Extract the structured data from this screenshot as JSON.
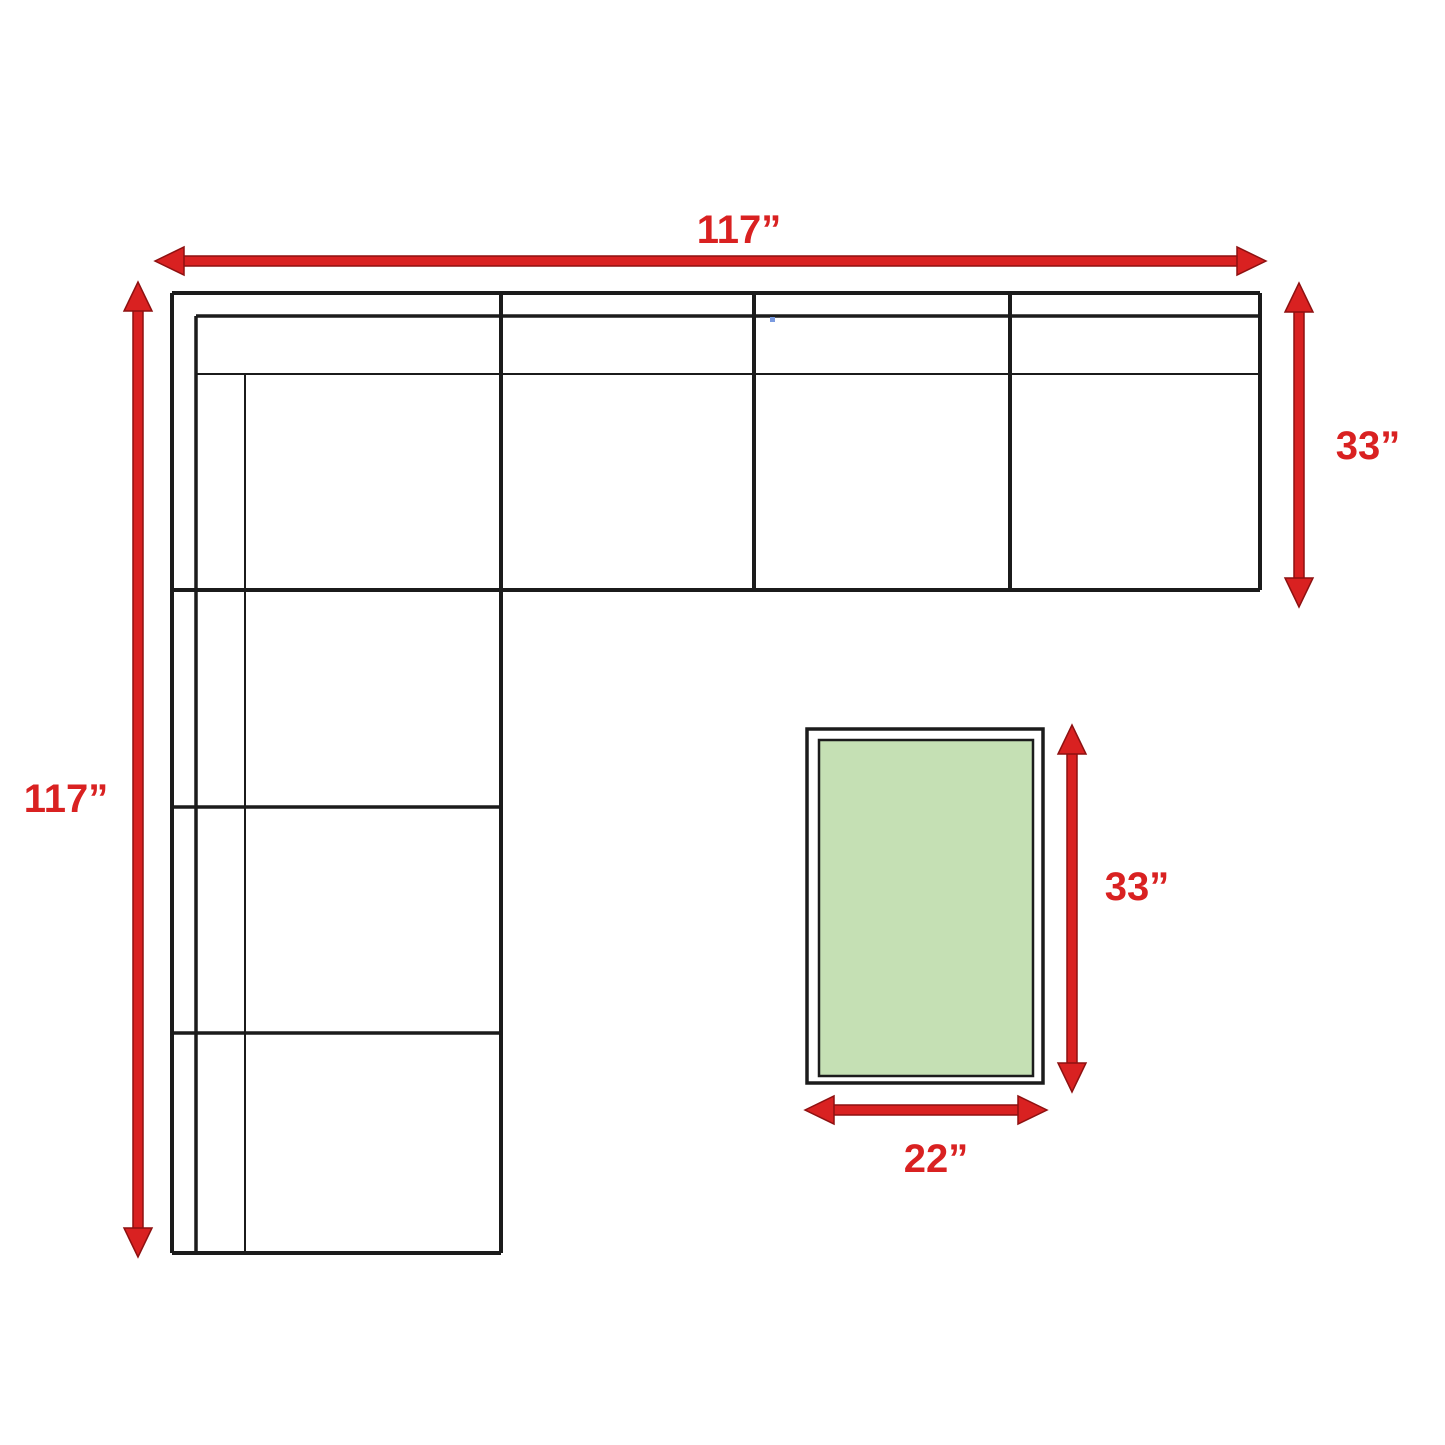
{
  "title": "Sectional sofa with ottoman dimension diagram",
  "dimensions": {
    "total_width": {
      "label": "117”"
    },
    "total_depth": {
      "label": "117”"
    },
    "section_depth": {
      "label": "33”"
    },
    "ottoman_length": {
      "label": "33”"
    },
    "ottoman_width": {
      "label": "22”"
    }
  },
  "colors": {
    "dimension_red": "#d92121",
    "dimension_red_outline": "#8e1111",
    "line_black": "#1b1b1b",
    "ottoman_green": "#c5e0b4",
    "background": "#ffffff",
    "artifact_blue": "#7b9be0"
  }
}
